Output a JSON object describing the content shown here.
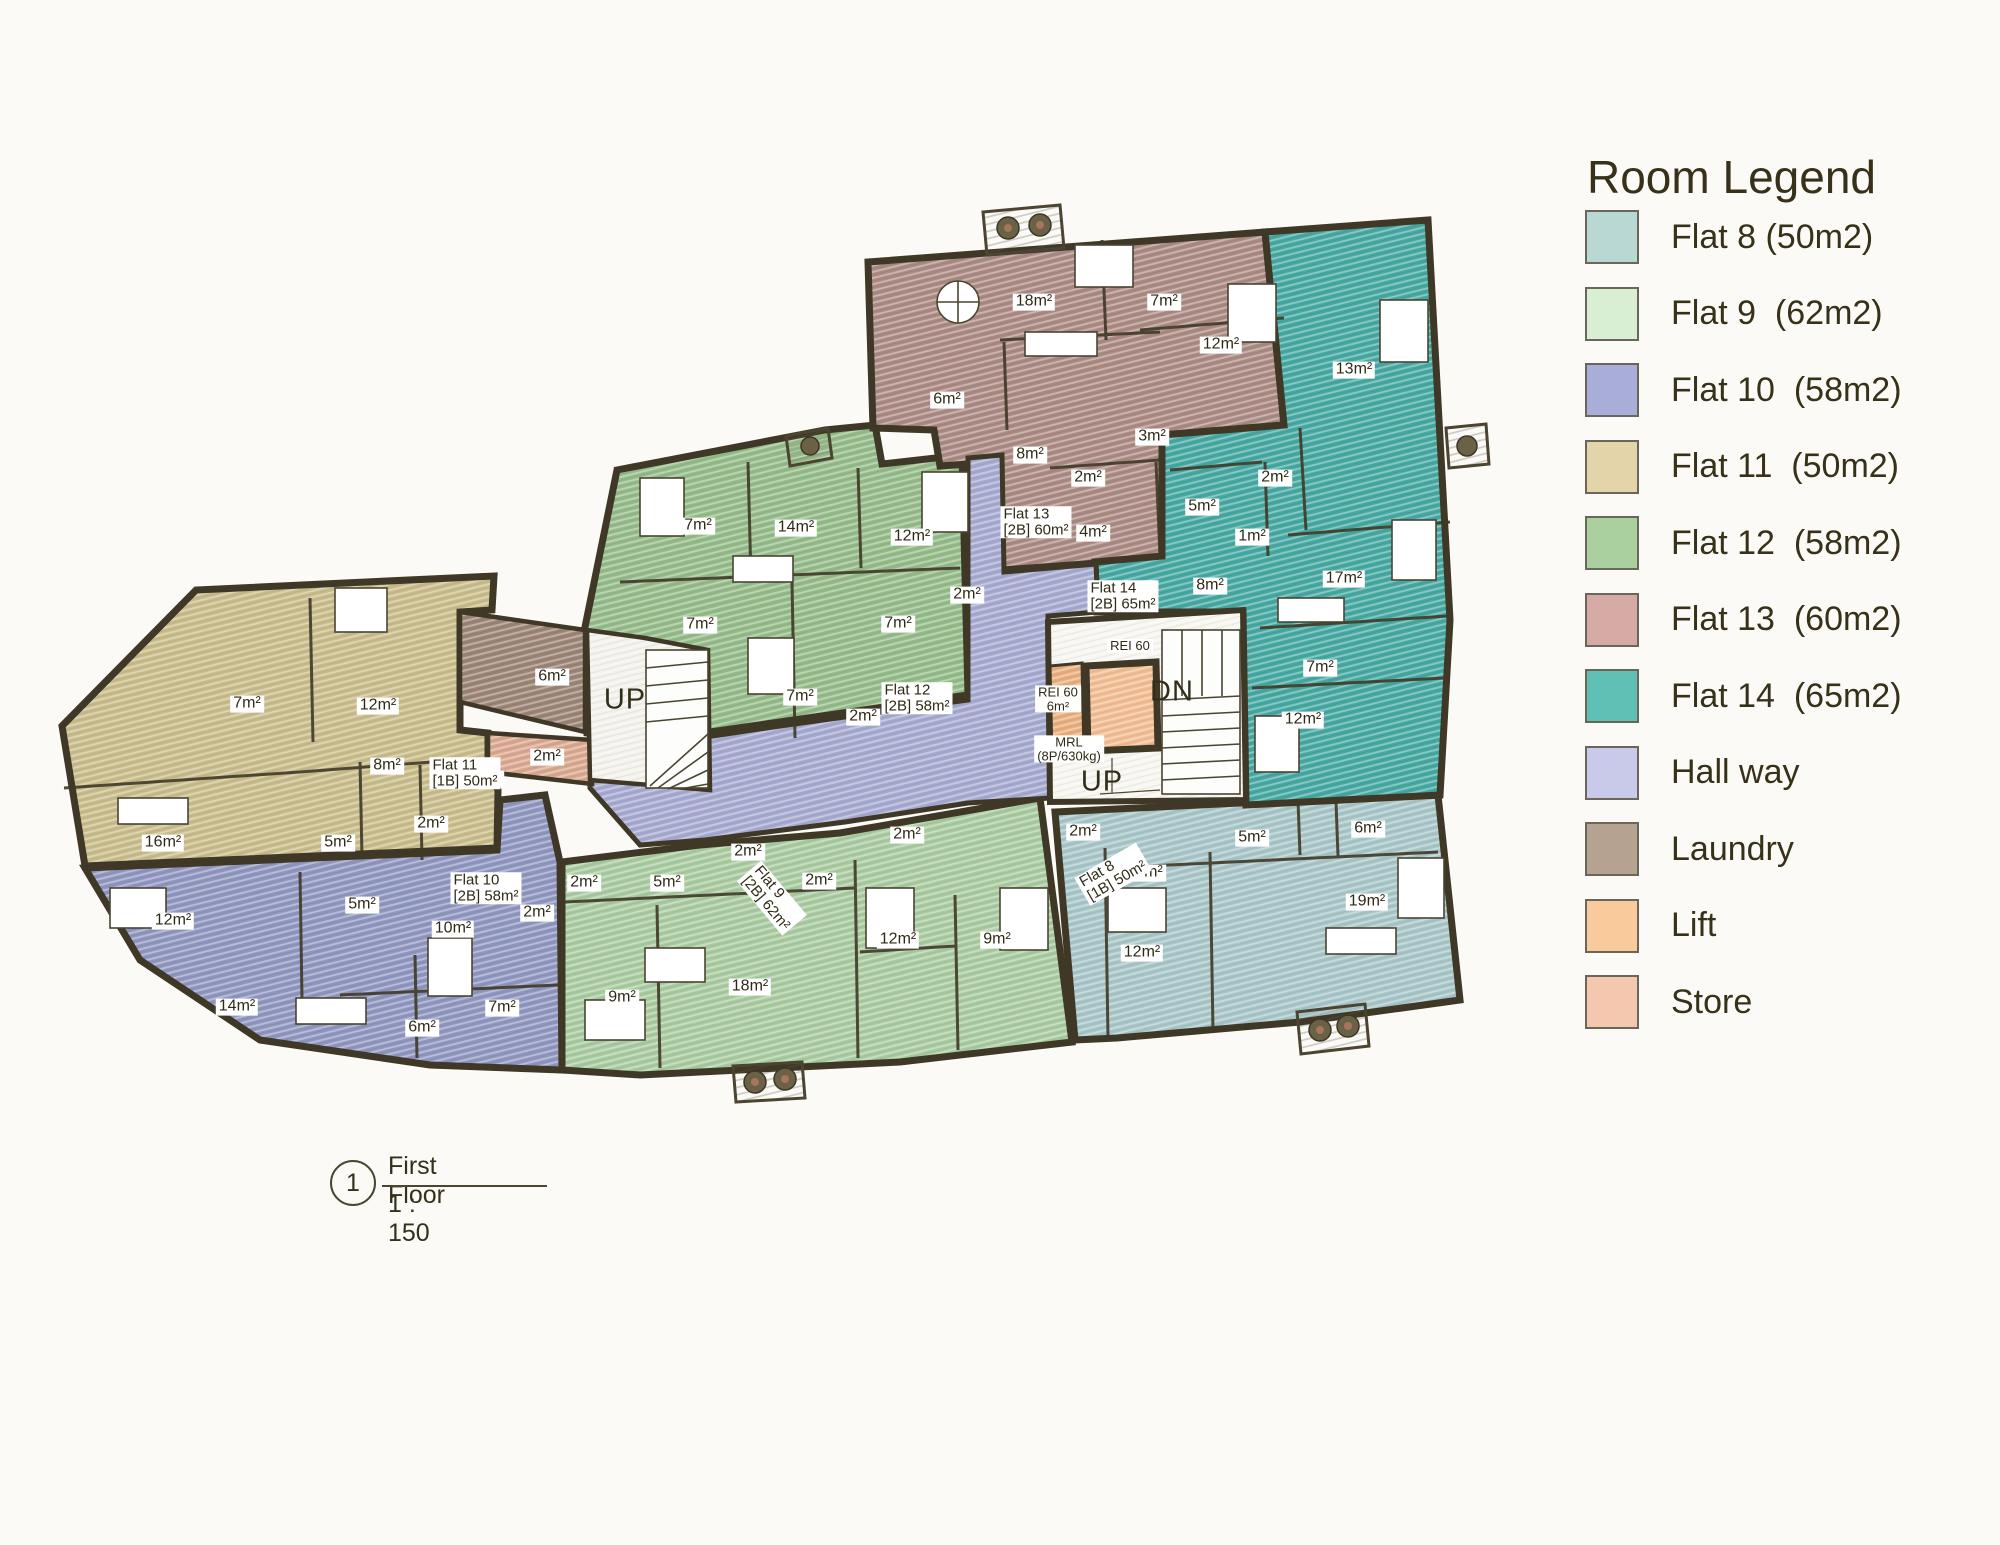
{
  "legend": {
    "title": "Room Legend",
    "items": [
      {
        "key": "flat8",
        "label": "Flat 8 (50m2)",
        "color": "#b9d7d3"
      },
      {
        "key": "flat9",
        "label": "Flat 9  (62m2)",
        "color": "#d9efd4"
      },
      {
        "key": "flat10",
        "label": "Flat 10  (58m2)",
        "color": "#a9aed8"
      },
      {
        "key": "flat11",
        "label": "Flat 11  (50m2)",
        "color": "#e3d5a9"
      },
      {
        "key": "flat12",
        "label": "Flat 12  (58m2)",
        "color": "#abd0a0"
      },
      {
        "key": "flat13",
        "label": "Flat 13  (60m2)",
        "color": "#d6aaa5"
      },
      {
        "key": "flat14",
        "label": "Flat 14  (65m2)",
        "color": "#61c0b6"
      },
      {
        "key": "hall",
        "label": "Hall way",
        "color": "#c9c9e9"
      },
      {
        "key": "laundry",
        "label": "Laundry",
        "color": "#b5a291"
      },
      {
        "key": "lift",
        "label": "Lift",
        "color": "#f8ca9c"
      },
      {
        "key": "store",
        "label": "Store",
        "color": "#f3c8ae"
      }
    ]
  },
  "title_block": {
    "number": "1",
    "name": "First Floor",
    "scale": "1 : 150"
  },
  "plan": {
    "wall_color": "#3f3827",
    "regions": {
      "flat8": "#a8c6c8",
      "flat9": "#a9cba0",
      "flat10": "#8f96bf",
      "flat11": "#c9bc8b",
      "flat12": "#94bb89",
      "flat13": "#ab8a83",
      "flat14": "#46a8a2",
      "hall": "#a6aad0",
      "laundry": "#9b8474",
      "store": "#d9a88f",
      "liftlobby": "#e8ae7e",
      "liftcar": "#f2bd93",
      "stair": "#f7f6f1",
      "lobby": "#f3f2ec"
    },
    "labels": [
      {
        "t": "18m²",
        "x": 1034,
        "y": 302,
        "k": "room"
      },
      {
        "t": "7m²",
        "x": 1164,
        "y": 302,
        "k": "room"
      },
      {
        "t": "12m²",
        "x": 1221,
        "y": 345,
        "k": "room"
      },
      {
        "t": "6m²",
        "x": 947,
        "y": 400,
        "k": "room"
      },
      {
        "t": "3m²",
        "x": 1152,
        "y": 437,
        "k": "room"
      },
      {
        "t": "8m²",
        "x": 1030,
        "y": 455,
        "k": "room"
      },
      {
        "t": "2m²",
        "x": 1088,
        "y": 478,
        "k": "room"
      },
      {
        "t": "4m²",
        "x": 1093,
        "y": 533,
        "k": "room"
      },
      {
        "t": "Flat 13\n[2B] 60m²",
        "x": 1036,
        "y": 522,
        "k": "flat"
      },
      {
        "t": "13m²",
        "x": 1354,
        "y": 370,
        "k": "room"
      },
      {
        "t": "2m²",
        "x": 1275,
        "y": 478,
        "k": "room"
      },
      {
        "t": "5m²",
        "x": 1202,
        "y": 507,
        "k": "room"
      },
      {
        "t": "1m²",
        "x": 1252,
        "y": 537,
        "k": "room"
      },
      {
        "t": "17m²",
        "x": 1344,
        "y": 579,
        "k": "room"
      },
      {
        "t": "8m²",
        "x": 1210,
        "y": 586,
        "k": "room"
      },
      {
        "t": "7m²",
        "x": 1320,
        "y": 668,
        "k": "room"
      },
      {
        "t": "12m²",
        "x": 1303,
        "y": 720,
        "k": "room"
      },
      {
        "t": "Flat 14\n[2B] 65m²",
        "x": 1123,
        "y": 596,
        "k": "flat"
      },
      {
        "t": "7m²",
        "x": 698,
        "y": 526,
        "k": "room"
      },
      {
        "t": "14m²",
        "x": 796,
        "y": 528,
        "k": "room"
      },
      {
        "t": "12m²",
        "x": 912,
        "y": 537,
        "k": "room"
      },
      {
        "t": "2m²",
        "x": 967,
        "y": 595,
        "k": "room"
      },
      {
        "t": "7m²",
        "x": 700,
        "y": 625,
        "k": "room"
      },
      {
        "t": "7m²",
        "x": 898,
        "y": 624,
        "k": "room"
      },
      {
        "t": "7m²",
        "x": 800,
        "y": 697,
        "k": "room"
      },
      {
        "t": "2m²",
        "x": 863,
        "y": 717,
        "k": "room"
      },
      {
        "t": "Flat 12\n[2B] 58m²",
        "x": 917,
        "y": 698,
        "k": "flat"
      },
      {
        "t": "7m²",
        "x": 247,
        "y": 704,
        "k": "room"
      },
      {
        "t": "12m²",
        "x": 378,
        "y": 706,
        "k": "room"
      },
      {
        "t": "8m²",
        "x": 387,
        "y": 766,
        "k": "room"
      },
      {
        "t": "2m²",
        "x": 487,
        "y": 779,
        "k": "room"
      },
      {
        "t": "2m²",
        "x": 431,
        "y": 824,
        "k": "room"
      },
      {
        "t": "16m²",
        "x": 163,
        "y": 843,
        "k": "room"
      },
      {
        "t": "5m²",
        "x": 338,
        "y": 843,
        "k": "room"
      },
      {
        "t": "Flat 11\n[1B] 50m²",
        "x": 465,
        "y": 773,
        "k": "flat"
      },
      {
        "t": "5m²",
        "x": 362,
        "y": 905,
        "k": "room"
      },
      {
        "t": "12m²",
        "x": 173,
        "y": 921,
        "k": "room"
      },
      {
        "t": "2m²",
        "x": 537,
        "y": 913,
        "k": "room"
      },
      {
        "t": "10m²",
        "x": 453,
        "y": 929,
        "k": "room"
      },
      {
        "t": "14m²",
        "x": 237,
        "y": 1007,
        "k": "room"
      },
      {
        "t": "7m²",
        "x": 502,
        "y": 1008,
        "k": "room"
      },
      {
        "t": "6m²",
        "x": 422,
        "y": 1028,
        "k": "room"
      },
      {
        "t": "Flat 10\n[2B] 58m²",
        "x": 486,
        "y": 888,
        "k": "flat"
      },
      {
        "t": "2m²",
        "x": 584,
        "y": 883,
        "k": "room"
      },
      {
        "t": "5m²",
        "x": 667,
        "y": 883,
        "k": "room"
      },
      {
        "t": "2m²",
        "x": 748,
        "y": 852,
        "k": "room"
      },
      {
        "t": "2m²",
        "x": 819,
        "y": 881,
        "k": "room"
      },
      {
        "t": "2m²",
        "x": 907,
        "y": 835,
        "k": "room"
      },
      {
        "t": "12m²",
        "x": 898,
        "y": 940,
        "k": "room"
      },
      {
        "t": "9m²",
        "x": 997,
        "y": 940,
        "k": "room"
      },
      {
        "t": "18m²",
        "x": 750,
        "y": 987,
        "k": "room"
      },
      {
        "t": "9m²",
        "x": 622,
        "y": 998,
        "k": "room"
      },
      {
        "t": "Flat 9\n[2B] 62m²",
        "x": 772,
        "y": 898,
        "k": "flat",
        "r": 50
      },
      {
        "t": "2m²",
        "x": 1083,
        "y": 832,
        "k": "room"
      },
      {
        "t": "6m²",
        "x": 1149,
        "y": 873,
        "k": "room"
      },
      {
        "t": "5m²",
        "x": 1252,
        "y": 838,
        "k": "room"
      },
      {
        "t": "6m²",
        "x": 1368,
        "y": 829,
        "k": "room"
      },
      {
        "t": "19m²",
        "x": 1367,
        "y": 902,
        "k": "room"
      },
      {
        "t": "12m²",
        "x": 1142,
        "y": 953,
        "k": "room"
      },
      {
        "t": "Flat 8\n[1B] 50m²",
        "x": 1113,
        "y": 874,
        "k": "flat",
        "r": -30
      },
      {
        "t": "6m²",
        "x": 552,
        "y": 677,
        "k": "room"
      },
      {
        "t": "2m²",
        "x": 547,
        "y": 757,
        "k": "room"
      },
      {
        "t": "REI 60",
        "x": 1130,
        "y": 646,
        "k": "tiny"
      },
      {
        "t": "REI 60\n6m²",
        "x": 1058,
        "y": 699,
        "k": "tiny"
      },
      {
        "t": "MRL\n(8P/630kg)",
        "x": 1069,
        "y": 749,
        "k": "tiny"
      },
      {
        "t": "UP",
        "x": 625,
        "y": 700,
        "k": "big"
      },
      {
        "t": "DN",
        "x": 1172,
        "y": 692,
        "k": "big"
      },
      {
        "t": "UP",
        "x": 1102,
        "y": 782,
        "k": "big"
      }
    ]
  }
}
